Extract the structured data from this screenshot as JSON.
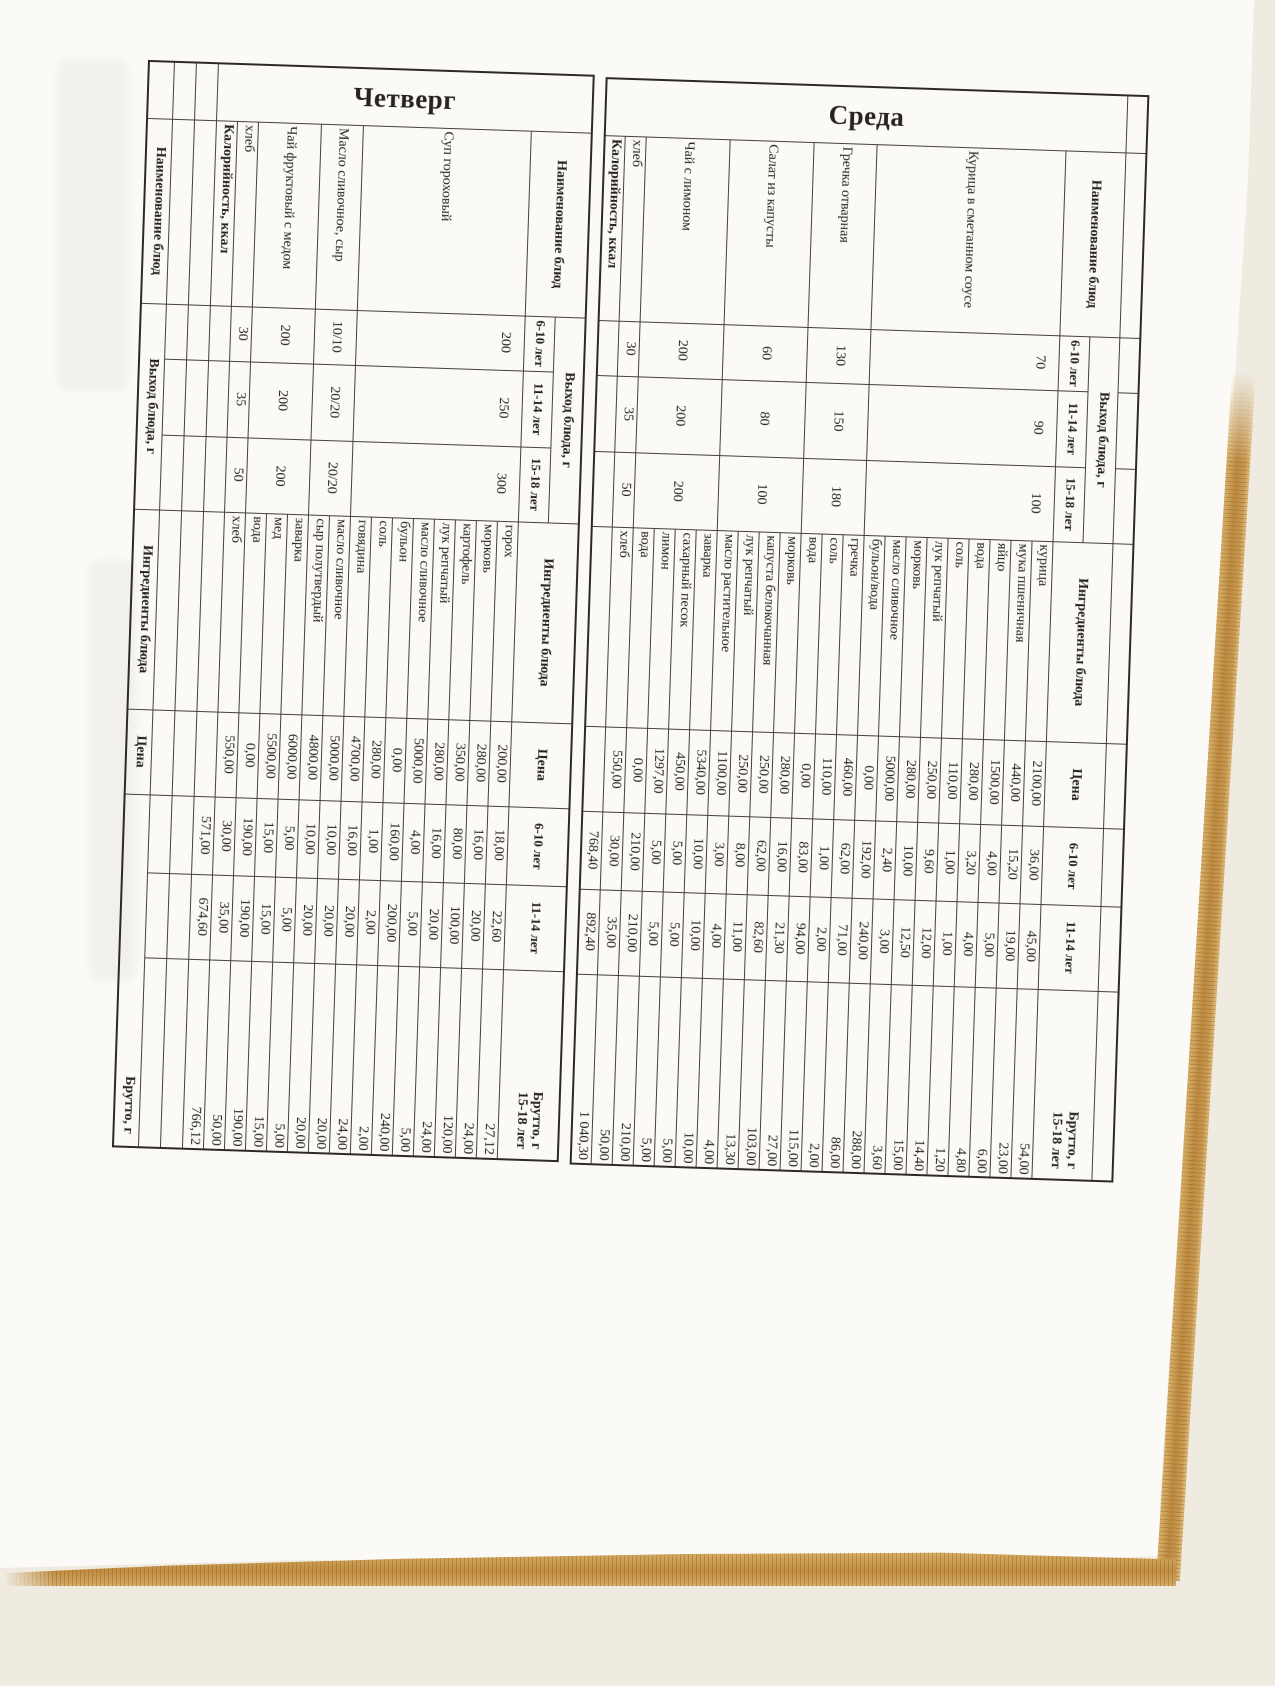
{
  "days": [
    {
      "title": "Четверг",
      "header": {
        "dish": "Наименование блюд",
        "yield_group": "Выход блюда, г",
        "ages": [
          "6-10 лет",
          "11-14 лет",
          "15-18 лет"
        ],
        "ingredients": "Ингредиенты блюда",
        "price": "Цена",
        "b1": "6-10 лет",
        "b2": "11-14 лет",
        "b3_line1": "Брутто, г",
        "b3_line2": "15-18 лет"
      },
      "leading_empty_row": false,
      "dishes": [
        {
          "name": "Суп гороховый",
          "yield": [
            "200",
            "250",
            "300"
          ],
          "ingredients": [
            [
              "горох",
              "200,00",
              "18,00",
              "22,60",
              "27,12"
            ],
            [
              "морковь",
              "280,00",
              "16,00",
              "20,00",
              "24,00"
            ],
            [
              "картофель",
              "350,00",
              "80,00",
              "100,00",
              "120,00"
            ],
            [
              "лук репчатый",
              "280,00",
              "16,00",
              "20,00",
              "24,00"
            ],
            [
              "масло сливочное",
              "5000,00",
              "4,00",
              "5,00",
              "5,00"
            ],
            [
              "бульон",
              "0,00",
              "160,00",
              "200,00",
              "240,00"
            ],
            [
              "соль",
              "280,00",
              "1,00",
              "2,00",
              "2,00"
            ],
            [
              "говядина",
              "4700,00",
              "16,00",
              "20,00",
              "24,00"
            ]
          ]
        },
        {
          "name": "Масло сливочное, сыр",
          "yield": [
            "10/10",
            "20/20",
            "20/20"
          ],
          "ingredients": [
            [
              "масло сливочное",
              "5000,00",
              "10,00",
              "20,00",
              "20,00"
            ],
            [
              "сыр полутвердый",
              "4800,00",
              "10,00",
              "20,00",
              "20,00"
            ]
          ]
        },
        {
          "name": "Чай фруктовый с медом",
          "yield": [
            "200",
            "200",
            "200"
          ],
          "ingredients": [
            [
              "заварка",
              "6000,00",
              "5,00",
              "5,00",
              "5,00"
            ],
            [
              "мед",
              "5500,00",
              "15,00",
              "15,00",
              "15,00"
            ],
            [
              "вода",
              "0,00",
              "190,00",
              "190,00",
              "190,00"
            ]
          ]
        },
        {
          "name": "хлеб",
          "yield": [
            "30",
            "35",
            "50"
          ],
          "ingredients": [
            [
              "хлеб",
              "550,00",
              "30,00",
              "35,00",
              "50,00"
            ]
          ]
        }
      ],
      "total_row": {
        "label": "Калорийность, ккал",
        "values": [
          "571,00",
          "674,60",
          "766,12"
        ]
      },
      "trailing_empty_rows": 2,
      "next_day_header": {
        "dish": "Наименование блюд",
        "yield_group": "Выход блюда, г",
        "ingredients": "Ингредиенты блюда",
        "price": "Цена",
        "brutto": "Брутто, г"
      }
    },
    {
      "title": "Среда",
      "header": {
        "dish": "Наименование блюд",
        "yield_group": "Выход блюда, г",
        "ages": [
          "6-10 лет",
          "11-14 лет",
          "15-18 лет"
        ],
        "ingredients": "Ингредиенты блюда",
        "price": "Цена",
        "b1": "6-10 лет",
        "b2": "11-14 лет",
        "b3_line1": "Брутто, г",
        "b3_line2": "15-18 лет"
      },
      "leading_empty_row": true,
      "dishes": [
        {
          "name": "Курица в сметанном соусе",
          "yield": [
            "70",
            "90",
            "100"
          ],
          "ingredients": [
            [
              "курица",
              "2100,00",
              "36,00",
              "45,00",
              "54,00"
            ],
            [
              "мука пшеничная",
              "440,00",
              "15,20",
              "19,00",
              "23,00"
            ],
            [
              "яйцо",
              "1500,00",
              "4,00",
              "5,00",
              "6,00"
            ],
            [
              "вода",
              "280,00",
              "3,20",
              "4,00",
              "4,80"
            ],
            [
              "соль",
              "110,00",
              "1,00",
              "1,00",
              "1,20"
            ],
            [
              "лук репчатый",
              "250,00",
              "9,60",
              "12,00",
              "14,40"
            ],
            [
              "морковь",
              "280,00",
              "10,00",
              "12,50",
              "15,00"
            ],
            [
              "масло сливочное",
              "5000,00",
              "2,40",
              "3,00",
              "3,60"
            ],
            [
              "бульон/вода",
              "0,00",
              "192,00",
              "240,00",
              "288,00"
            ]
          ]
        },
        {
          "name": "Гречка отварная",
          "yield": [
            "130",
            "150",
            "180"
          ],
          "ingredients": [
            [
              "гречка",
              "460,00",
              "62,00",
              "71,00",
              "86,00"
            ],
            [
              "соль",
              "110,00",
              "1,00",
              "2,00",
              "2,00"
            ],
            [
              "вода",
              "0,00",
              "83,00",
              "94,00",
              "115,00"
            ]
          ]
        },
        {
          "name": "Салат из капусты",
          "yield": [
            "60",
            "80",
            "100"
          ],
          "ingredients": [
            [
              "морковь",
              "280,00",
              "16,00",
              "21,30",
              "27,00"
            ],
            [
              "капуста белокочанная",
              "250,00",
              "62,00",
              "82,60",
              "103,00"
            ],
            [
              "лук репчатый",
              "250,00",
              "8,00",
              "11,00",
              "13,30"
            ],
            [
              "масло растительное",
              "1100,00",
              "3,00",
              "4,00",
              "4,00"
            ]
          ]
        },
        {
          "name": "Чай с лимоном",
          "yield": [
            "200",
            "200",
            "200"
          ],
          "ingredients": [
            [
              "заварка",
              "5340,00",
              "10,00",
              "10,00",
              "10,00"
            ],
            [
              "сахарный песок",
              "450,00",
              "5,00",
              "5,00",
              "5,00"
            ],
            [
              "лимон",
              "1297,00",
              "5,00",
              "5,00",
              "5,00"
            ],
            [
              "вода",
              "0,00",
              "210,00",
              "210,00",
              "210,00"
            ]
          ]
        },
        {
          "name": "хлеб",
          "yield": [
            "30",
            "35",
            "50"
          ],
          "ingredients": [
            [
              "хлеб",
              "550,00",
              "30,00",
              "35,00",
              "50,00"
            ]
          ]
        }
      ],
      "total_row": {
        "label": "Калорийность, ккал",
        "values": [
          "768,40",
          "892,40",
          "1 040,30"
        ]
      },
      "trailing_empty_rows": 0,
      "next_day_header": null
    }
  ]
}
